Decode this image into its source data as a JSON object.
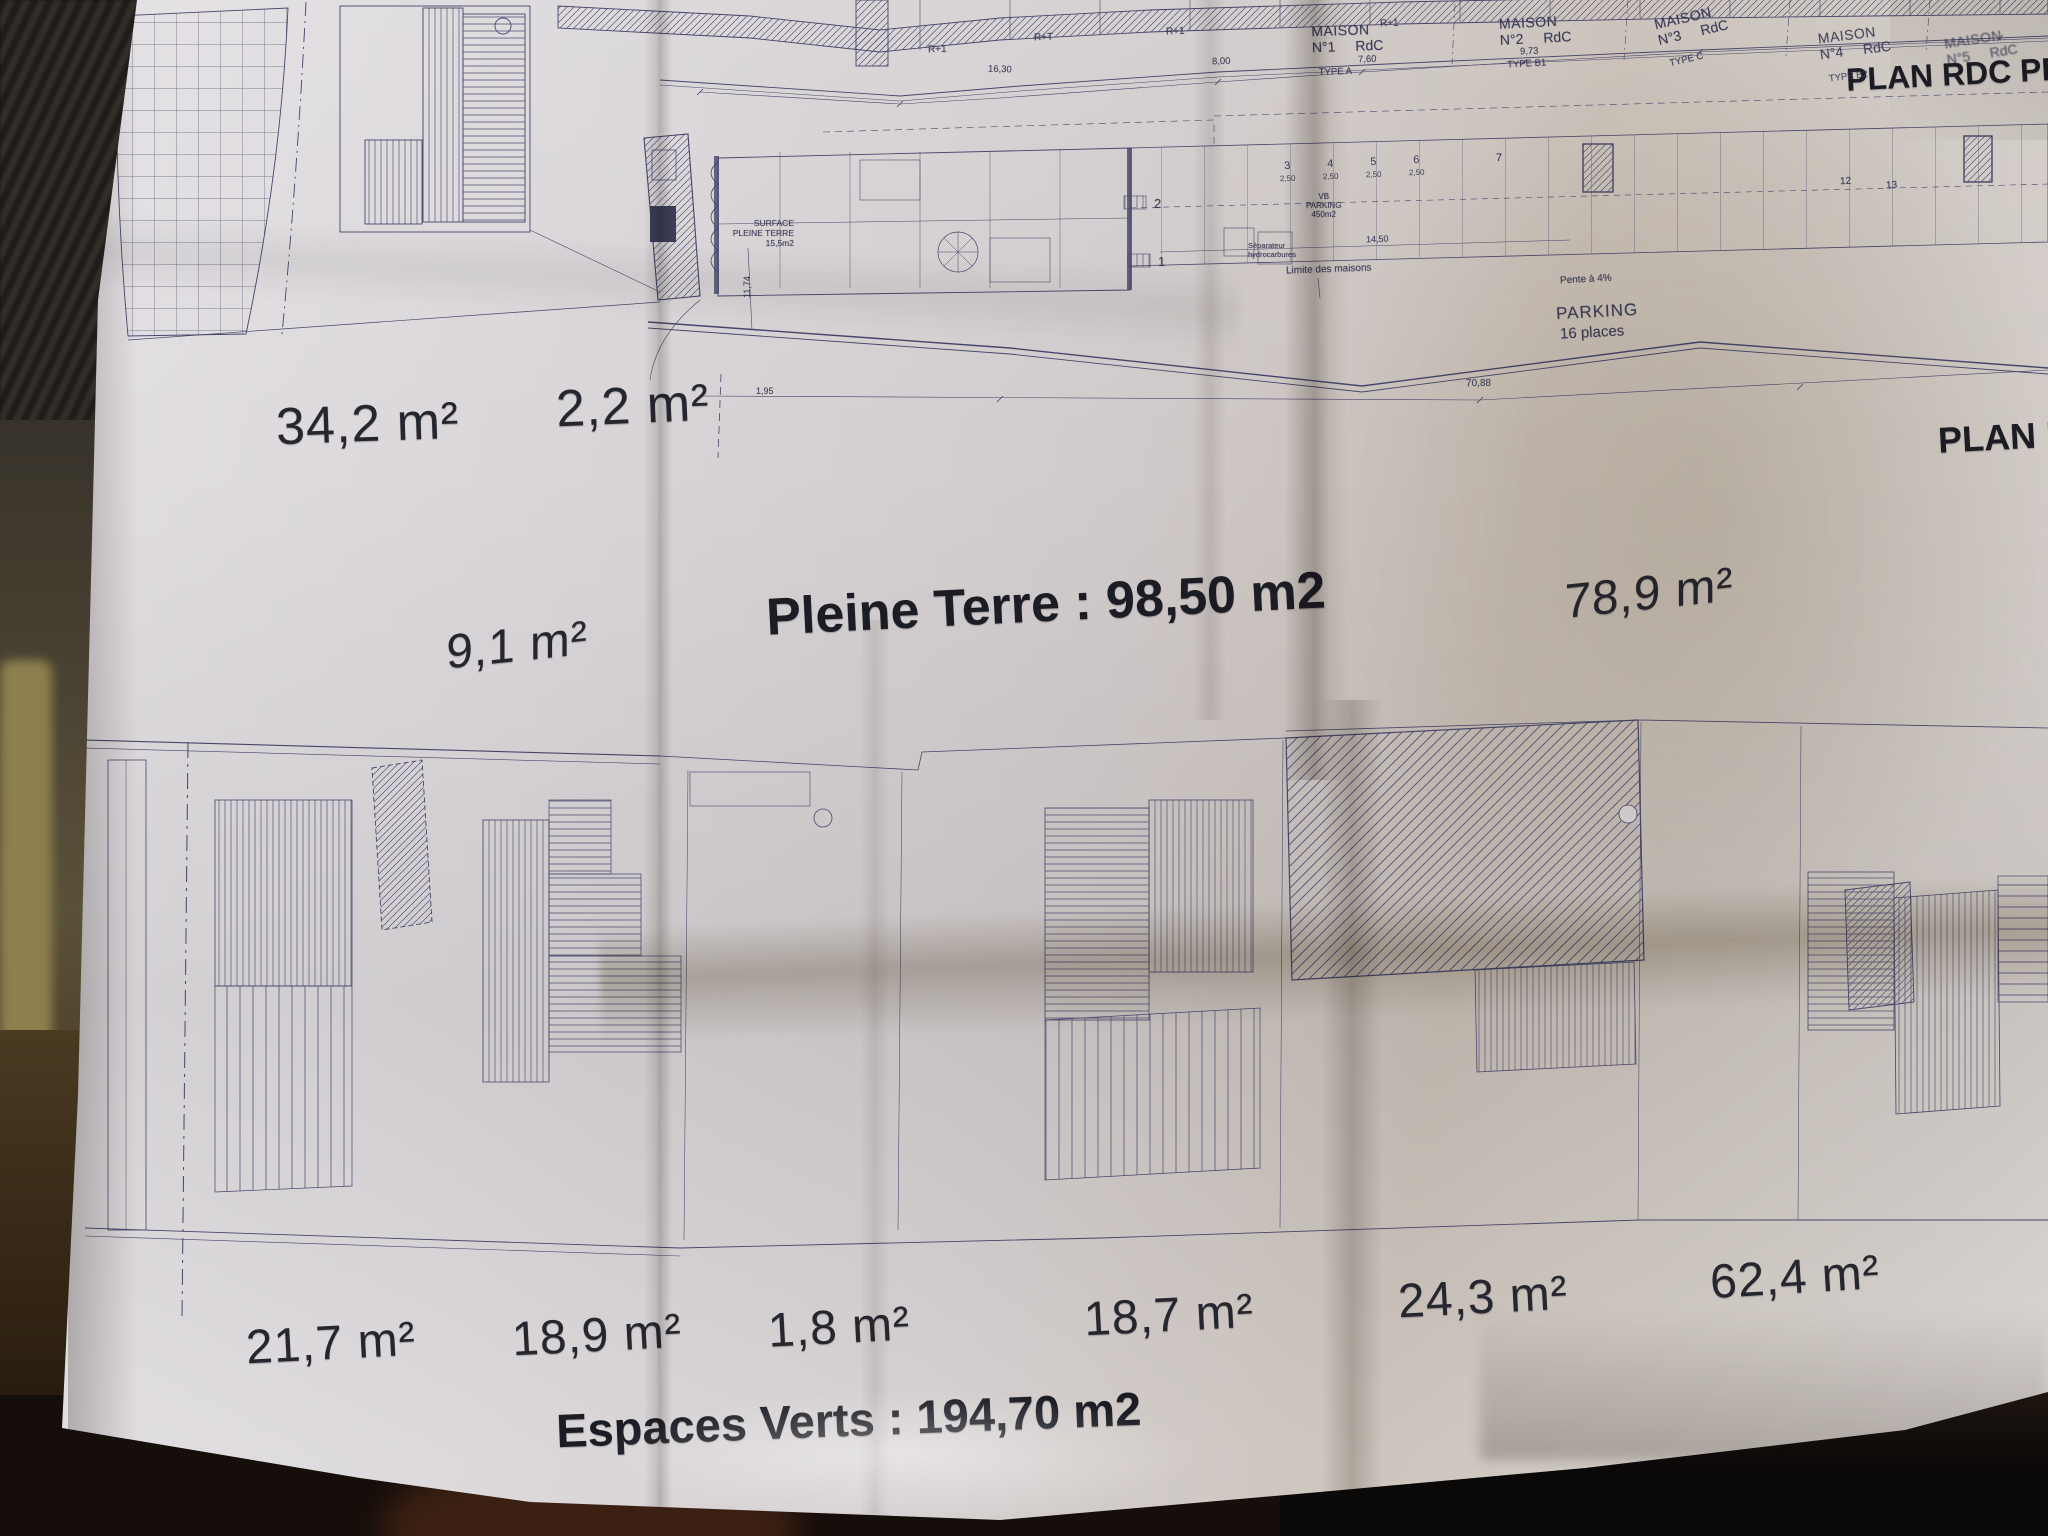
{
  "plan": {
    "titles": {
      "plan_rdc": "PLAN RDC PR",
      "plan_r": "PLAN R-",
      "pleine_terre": "Pleine Terre : 98,50 m2",
      "espaces_verts": "Espaces Verts : 194,70 m2"
    },
    "areas": {
      "upper": [
        "34,2 m²",
        "2,2 m²"
      ],
      "middle": [
        "9,1 m²",
        "78,9 m²"
      ],
      "bottom": [
        "21,7 m²",
        "18,9 m²",
        "1,8 m²",
        "18,7 m²",
        "24,3 m²",
        "62,4 m²"
      ]
    },
    "houses": [
      {
        "label": "MAISON",
        "num": "N°1",
        "floor": "RdC",
        "type": "TYPE A",
        "width": "7,60"
      },
      {
        "label": "MAISON",
        "num": "N°2",
        "floor": "RdC",
        "type": "TYPE B1",
        "width": "9,73"
      },
      {
        "label": "MAISON",
        "num": "N°3",
        "floor": "RdC",
        "type": "TYPE C",
        "width": ""
      },
      {
        "label": "MAISON",
        "num": "N°4",
        "floor": "RdC",
        "type": "TYPE B2",
        "width": ""
      },
      {
        "label": "MAISON",
        "num": "N°5",
        "floor": "RdC",
        "type": "",
        "width": ""
      }
    ],
    "levels": [
      "R+1",
      "R+T",
      "R+1",
      "R+1"
    ],
    "parking": {
      "title": "PARKING",
      "places": "16 places",
      "stalls": [
        {
          "num": "3",
          "w": "2,50"
        },
        {
          "num": "4",
          "w": "2,50"
        },
        {
          "num": "5",
          "w": "2,50"
        },
        {
          "num": "6",
          "w": "2,50"
        }
      ],
      "extra_stall": "7",
      "upper_numbers": [
        "12",
        "13"
      ],
      "area_note": "VB\nPARKING\n450m2",
      "unit_numbers": [
        "2",
        "1"
      ]
    },
    "notes": {
      "pente": "Pente à 4%",
      "limite": "Limite des maisons",
      "surface": "SURFACE\nPLEINE TERRE\n15,5m2",
      "separateur": "Séparateur\nhydrocarbures"
    },
    "dimensions": {
      "top_left": "16,30",
      "top_mid": "8,00",
      "bottom": "70,88",
      "parking": "14,50",
      "left": "1,95",
      "vertical": "11,74"
    }
  },
  "colors": {
    "ink": "#46466a",
    "paper": "#d6d1d3",
    "text": "#26262f"
  }
}
